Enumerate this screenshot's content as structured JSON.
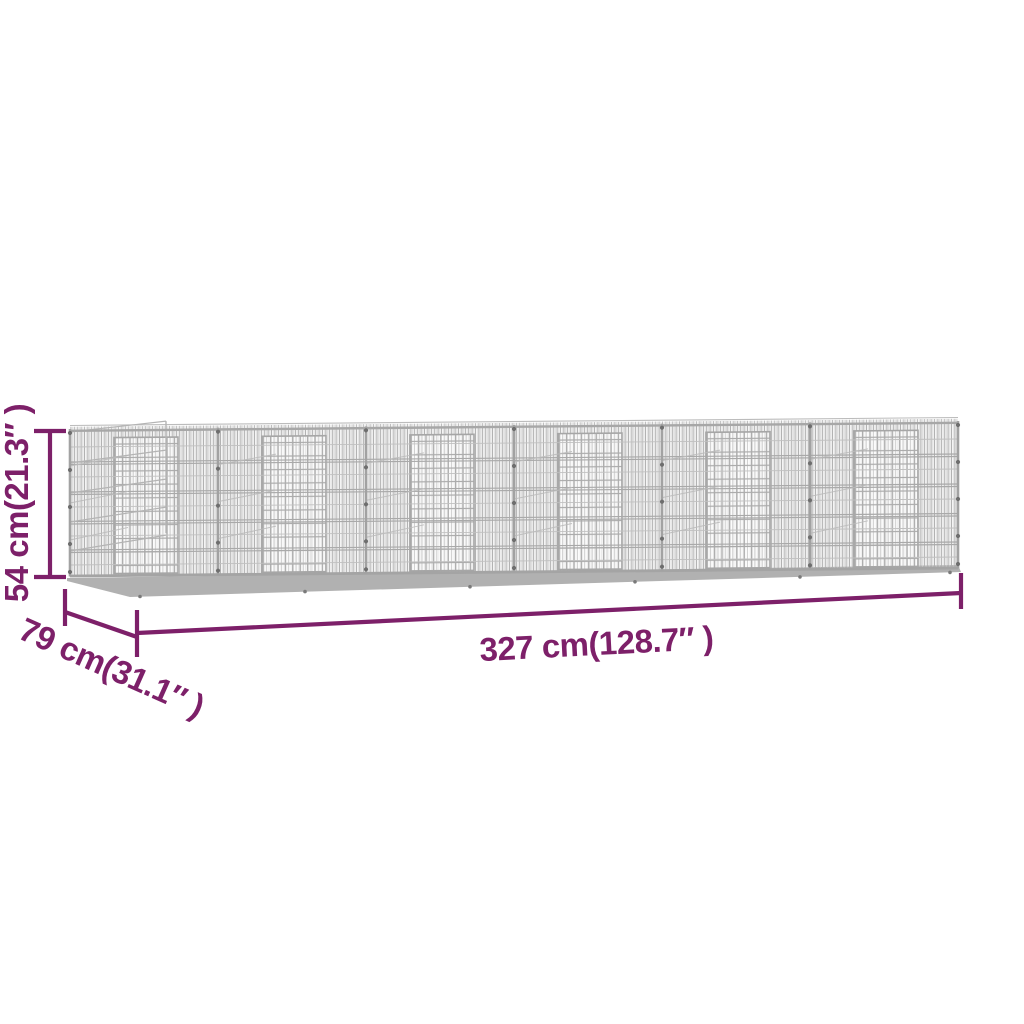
{
  "figure": {
    "type": "product-dimension-diagram",
    "subject": "Galvanised grey wire rabbit cage / outdoor pen with 6 mesh panels and doors",
    "background": "#ffffff"
  },
  "colors": {
    "accent": "#7d2069",
    "wire": "#b0b0b0",
    "wire_frame": "#a2a2a2",
    "base": "#b1b1b1",
    "clip_dot": "#6e6e6e"
  },
  "dimensions": {
    "height": {
      "label": "54 cm(21.3″ )",
      "cm": "54",
      "inches": "21.3"
    },
    "depth": {
      "label": "79 cm(31.1″ )",
      "cm": "79",
      "inches": "31.1"
    },
    "width": {
      "label": "327 cm(128.7″ )",
      "cm": "327",
      "inches": "128.7"
    }
  }
}
